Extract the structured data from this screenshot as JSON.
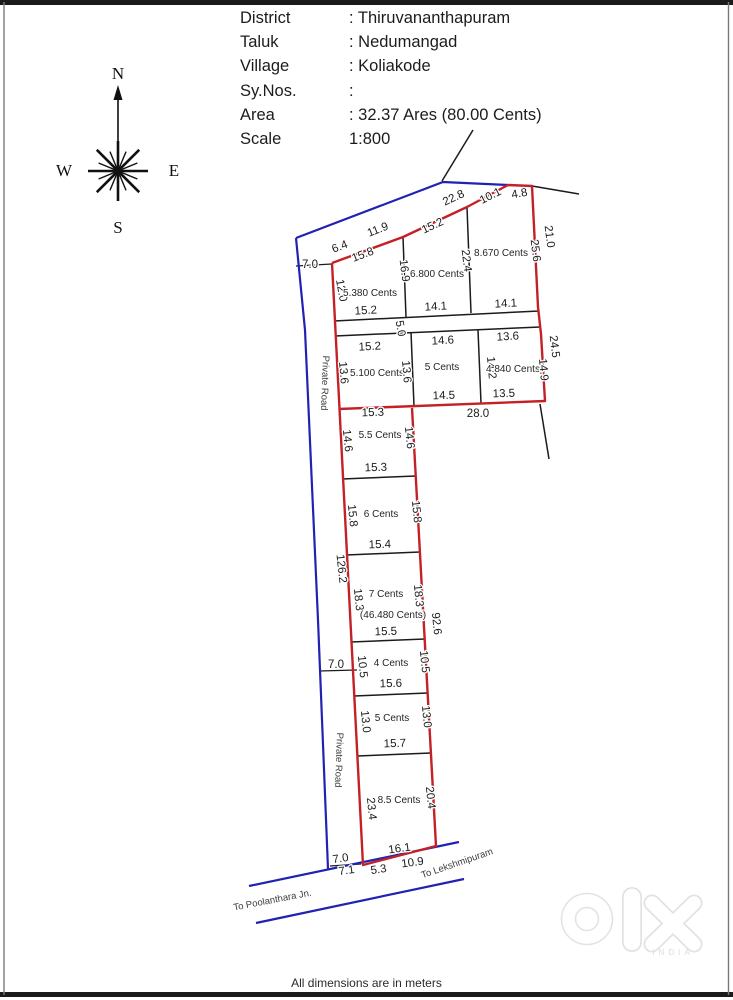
{
  "header": {
    "rows": [
      {
        "label": "District",
        "value": ": Thiruvananthapuram"
      },
      {
        "label": "Taluk",
        "value": ": Nedumangad"
      },
      {
        "label": "Village",
        "value": ": Koliakode"
      },
      {
        "label": "Sy.Nos.",
        "value": ":"
      },
      {
        "label": "Area",
        "value": ": 32.37 Ares (80.00 Cents)"
      },
      {
        "label": "Scale",
        "value": "1:800"
      }
    ]
  },
  "compass": {
    "n": "N",
    "e": "E",
    "s": "S",
    "w": "W"
  },
  "colors": {
    "boundary_red": "#c42127",
    "road_blue": "#2222b2",
    "line_black": "#1b1b1b"
  },
  "labels": [
    {
      "id": "road-width-top",
      "t": "7.0"
    },
    {
      "id": "outer-seg-6-4",
      "t": "6.4"
    },
    {
      "id": "outer-seg-11-9",
      "t": "11.9"
    },
    {
      "id": "frontage-15-8",
      "t": "15.8"
    },
    {
      "id": "outer-seg-22-8",
      "t": "22.8"
    },
    {
      "id": "frontage-15-2",
      "t": "15.2"
    },
    {
      "id": "outer-seg-10-1",
      "t": "10.1"
    },
    {
      "id": "outer-seg-4-8",
      "t": "4.8"
    },
    {
      "id": "east-side-21-0",
      "t": "21.0"
    },
    {
      "id": "east-side-25-6",
      "t": "25.6"
    },
    {
      "id": "west-side-12-0",
      "t": "12.0"
    },
    {
      "id": "plot-5-380-cents",
      "t": "5.380 Cents"
    },
    {
      "id": "divider-16-9",
      "t": "16.9"
    },
    {
      "id": "plot-6-800-cents",
      "t": "6.800 Cents"
    },
    {
      "id": "divider-22-4",
      "t": "22.4"
    },
    {
      "id": "plot-8-670-cents",
      "t": "8.670 Cents"
    },
    {
      "id": "block1-bottom-15-2",
      "t": "15.2"
    },
    {
      "id": "block1-bottom-14-1a",
      "t": "14.1"
    },
    {
      "id": "block1-bottom-14-1b",
      "t": "14.1"
    },
    {
      "id": "strip-width-5-0",
      "t": "5.0"
    },
    {
      "id": "block2-top-15-2",
      "t": "15.2"
    },
    {
      "id": "block2-top-14-6",
      "t": "14.6"
    },
    {
      "id": "block2-top-13-6",
      "t": "13.6"
    },
    {
      "id": "east-side-24-5",
      "t": "24.5"
    },
    {
      "id": "block2-left-13-6",
      "t": "13.6"
    },
    {
      "id": "plot-5-100-cents",
      "t": "5.100 Cents"
    },
    {
      "id": "block2-mid-13-6",
      "t": "13.6"
    },
    {
      "id": "plot-5-cents-a",
      "t": "5 Cents"
    },
    {
      "id": "block2-mid-14-2",
      "t": "14.2"
    },
    {
      "id": "plot-4-840-cents",
      "t": "4.840 Cents"
    },
    {
      "id": "block2-right-14-9",
      "t": "14.9"
    },
    {
      "id": "block2-bottom-14-5",
      "t": "14.5"
    },
    {
      "id": "block2-bottom-13-5",
      "t": "13.5"
    },
    {
      "id": "south-width-28-0",
      "t": "28.0"
    },
    {
      "id": "col-top-15-3",
      "t": "15.3"
    },
    {
      "id": "private-road-upper",
      "t": "Private Road"
    },
    {
      "id": "col1-left-14-6",
      "t": "14.6"
    },
    {
      "id": "plot-5-5-cents",
      "t": "5.5 Cents"
    },
    {
      "id": "col1-right-14-6",
      "t": "14.6"
    },
    {
      "id": "col-div-15-3",
      "t": "15.3"
    },
    {
      "id": "col2-left-15-8",
      "t": "15.8"
    },
    {
      "id": "plot-6-cents",
      "t": "6 Cents"
    },
    {
      "id": "col2-right-15-8",
      "t": "15.8"
    },
    {
      "id": "col-div-15-4",
      "t": "15.4"
    },
    {
      "id": "west-boundary-126-2",
      "t": "126.2"
    },
    {
      "id": "col3-left-18-3",
      "t": "18.3"
    },
    {
      "id": "plot-7-cents",
      "t": "7 Cents"
    },
    {
      "id": "col3-right-18-3",
      "t": "18.3"
    },
    {
      "id": "plot-46-480-cents",
      "t": "(46.480 Cents)"
    },
    {
      "id": "east-boundary-92-6",
      "t": "92.6"
    },
    {
      "id": "col-div-15-5",
      "t": "15.5"
    },
    {
      "id": "col4-left-10-5",
      "t": "10.5"
    },
    {
      "id": "plot-4-cents",
      "t": "4 Cents"
    },
    {
      "id": "col4-right-10-5",
      "t": "10.5"
    },
    {
      "id": "road-width-mid",
      "t": "7.0"
    },
    {
      "id": "col-div-15-6",
      "t": "15.6"
    },
    {
      "id": "col5-left-13-0",
      "t": "13.0"
    },
    {
      "id": "plot-5-cents-b",
      "t": "5 Cents"
    },
    {
      "id": "col5-right-13-0",
      "t": "13.0"
    },
    {
      "id": "col-div-15-7",
      "t": "15.7"
    },
    {
      "id": "private-road-lower",
      "t": "Private Road"
    },
    {
      "id": "col6-left-23-4",
      "t": "23.4"
    },
    {
      "id": "plot-8-5-cents",
      "t": "8.5 Cents"
    },
    {
      "id": "col6-right-20-4",
      "t": "20.4"
    },
    {
      "id": "col-bottom-16-1",
      "t": "16.1"
    },
    {
      "id": "road-width-bottom-7-0",
      "t": "7.0"
    },
    {
      "id": "road-width-bottom-7-1",
      "t": "7.1"
    },
    {
      "id": "road-seg-5-3",
      "t": "5.3"
    },
    {
      "id": "road-seg-10-9",
      "t": "10.9"
    },
    {
      "id": "road-to-lekshmipuram",
      "t": "To Lekshmipuram"
    },
    {
      "id": "road-to-poolanthara",
      "t": "To Poolanthara Jn."
    }
  ],
  "footer": {
    "note": "All dimensions are in meters"
  },
  "watermark": {
    "country": "INDIA"
  }
}
